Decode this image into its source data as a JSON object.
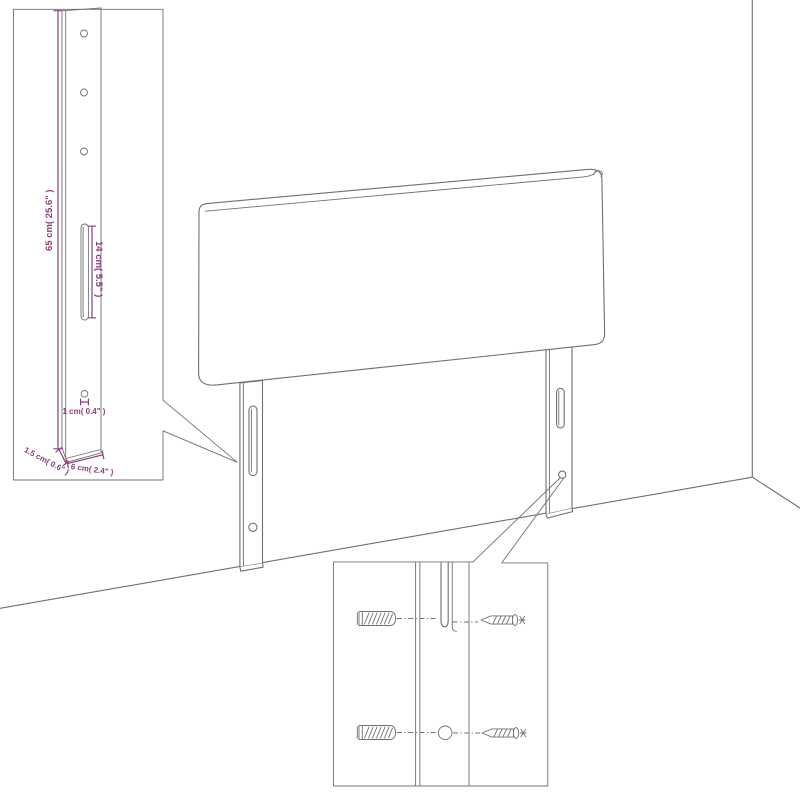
{
  "colors": {
    "line": "#707070",
    "dim": "#8a3f7c",
    "bg": "#ffffff"
  },
  "leg_detail": {
    "height_label": "65 cm( 25.6\" )",
    "slot_label": "14 cm( 5.5\" )",
    "hole_label": "1 cm( 0.4\" )",
    "depth_label": "1.5 cm( 0.6\" )",
    "width_label": "6 cm( 2.4\" )"
  },
  "mounting_detail": {
    "icons": [
      "wall-plug-icon",
      "screw-icon",
      "mounting-slot",
      "pilot-hole"
    ]
  }
}
